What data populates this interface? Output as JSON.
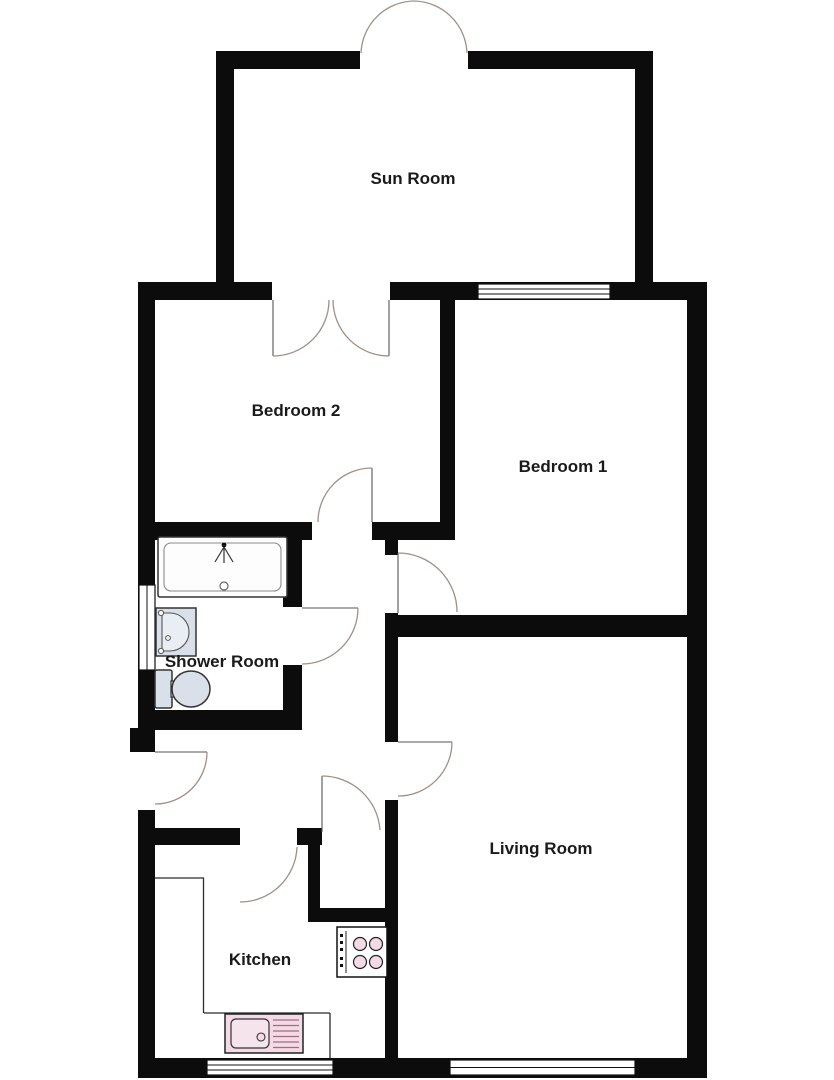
{
  "floorplan": {
    "type": "residential-floor-plan",
    "rooms": {
      "sun_room": {
        "label": "Sun Room"
      },
      "bedroom_2": {
        "label": "Bedroom 2"
      },
      "bedroom_1": {
        "label": "Bedroom 1"
      },
      "shower_room": {
        "label": "Shower Room"
      },
      "living_room": {
        "label": "Living Room"
      },
      "kitchen": {
        "label": "Kitchen"
      }
    },
    "fixtures": {
      "bath": "bath-with-shower-icon",
      "basin": "wash-basin-icon",
      "toilet": "toilet-icon",
      "hob": "four-ring-hob-icon",
      "kitchen_sink": "sink-with-drainer-icon",
      "worktop": "kitchen-worktop-outline"
    },
    "openings": {
      "sun_room_french_doors": "double doors opening outward at top",
      "sun_room_to_bedroom_2": "double doors opening into Bedroom 2",
      "entrance_door": "single door in left outer wall opening into hall",
      "doors": [
        "bedroom-2",
        "bedroom-1",
        "shower-room",
        "living-room",
        "kitchen",
        "hall-cupboard"
      ],
      "windows": [
        "bedroom-1-front",
        "shower-room-side",
        "kitchen-rear",
        "living-room-rear"
      ]
    },
    "colors": {
      "wall": "#0c0c0c",
      "floor": "#ffffff",
      "bathroom_fixture_fill": "#d9e0e9",
      "bathroom_bowl_fill": "#e9eef4",
      "kitchen_fixture_fill": "#f3dae5",
      "door_swing": "#9e9088",
      "label_text": "#1a1a1a"
    }
  }
}
